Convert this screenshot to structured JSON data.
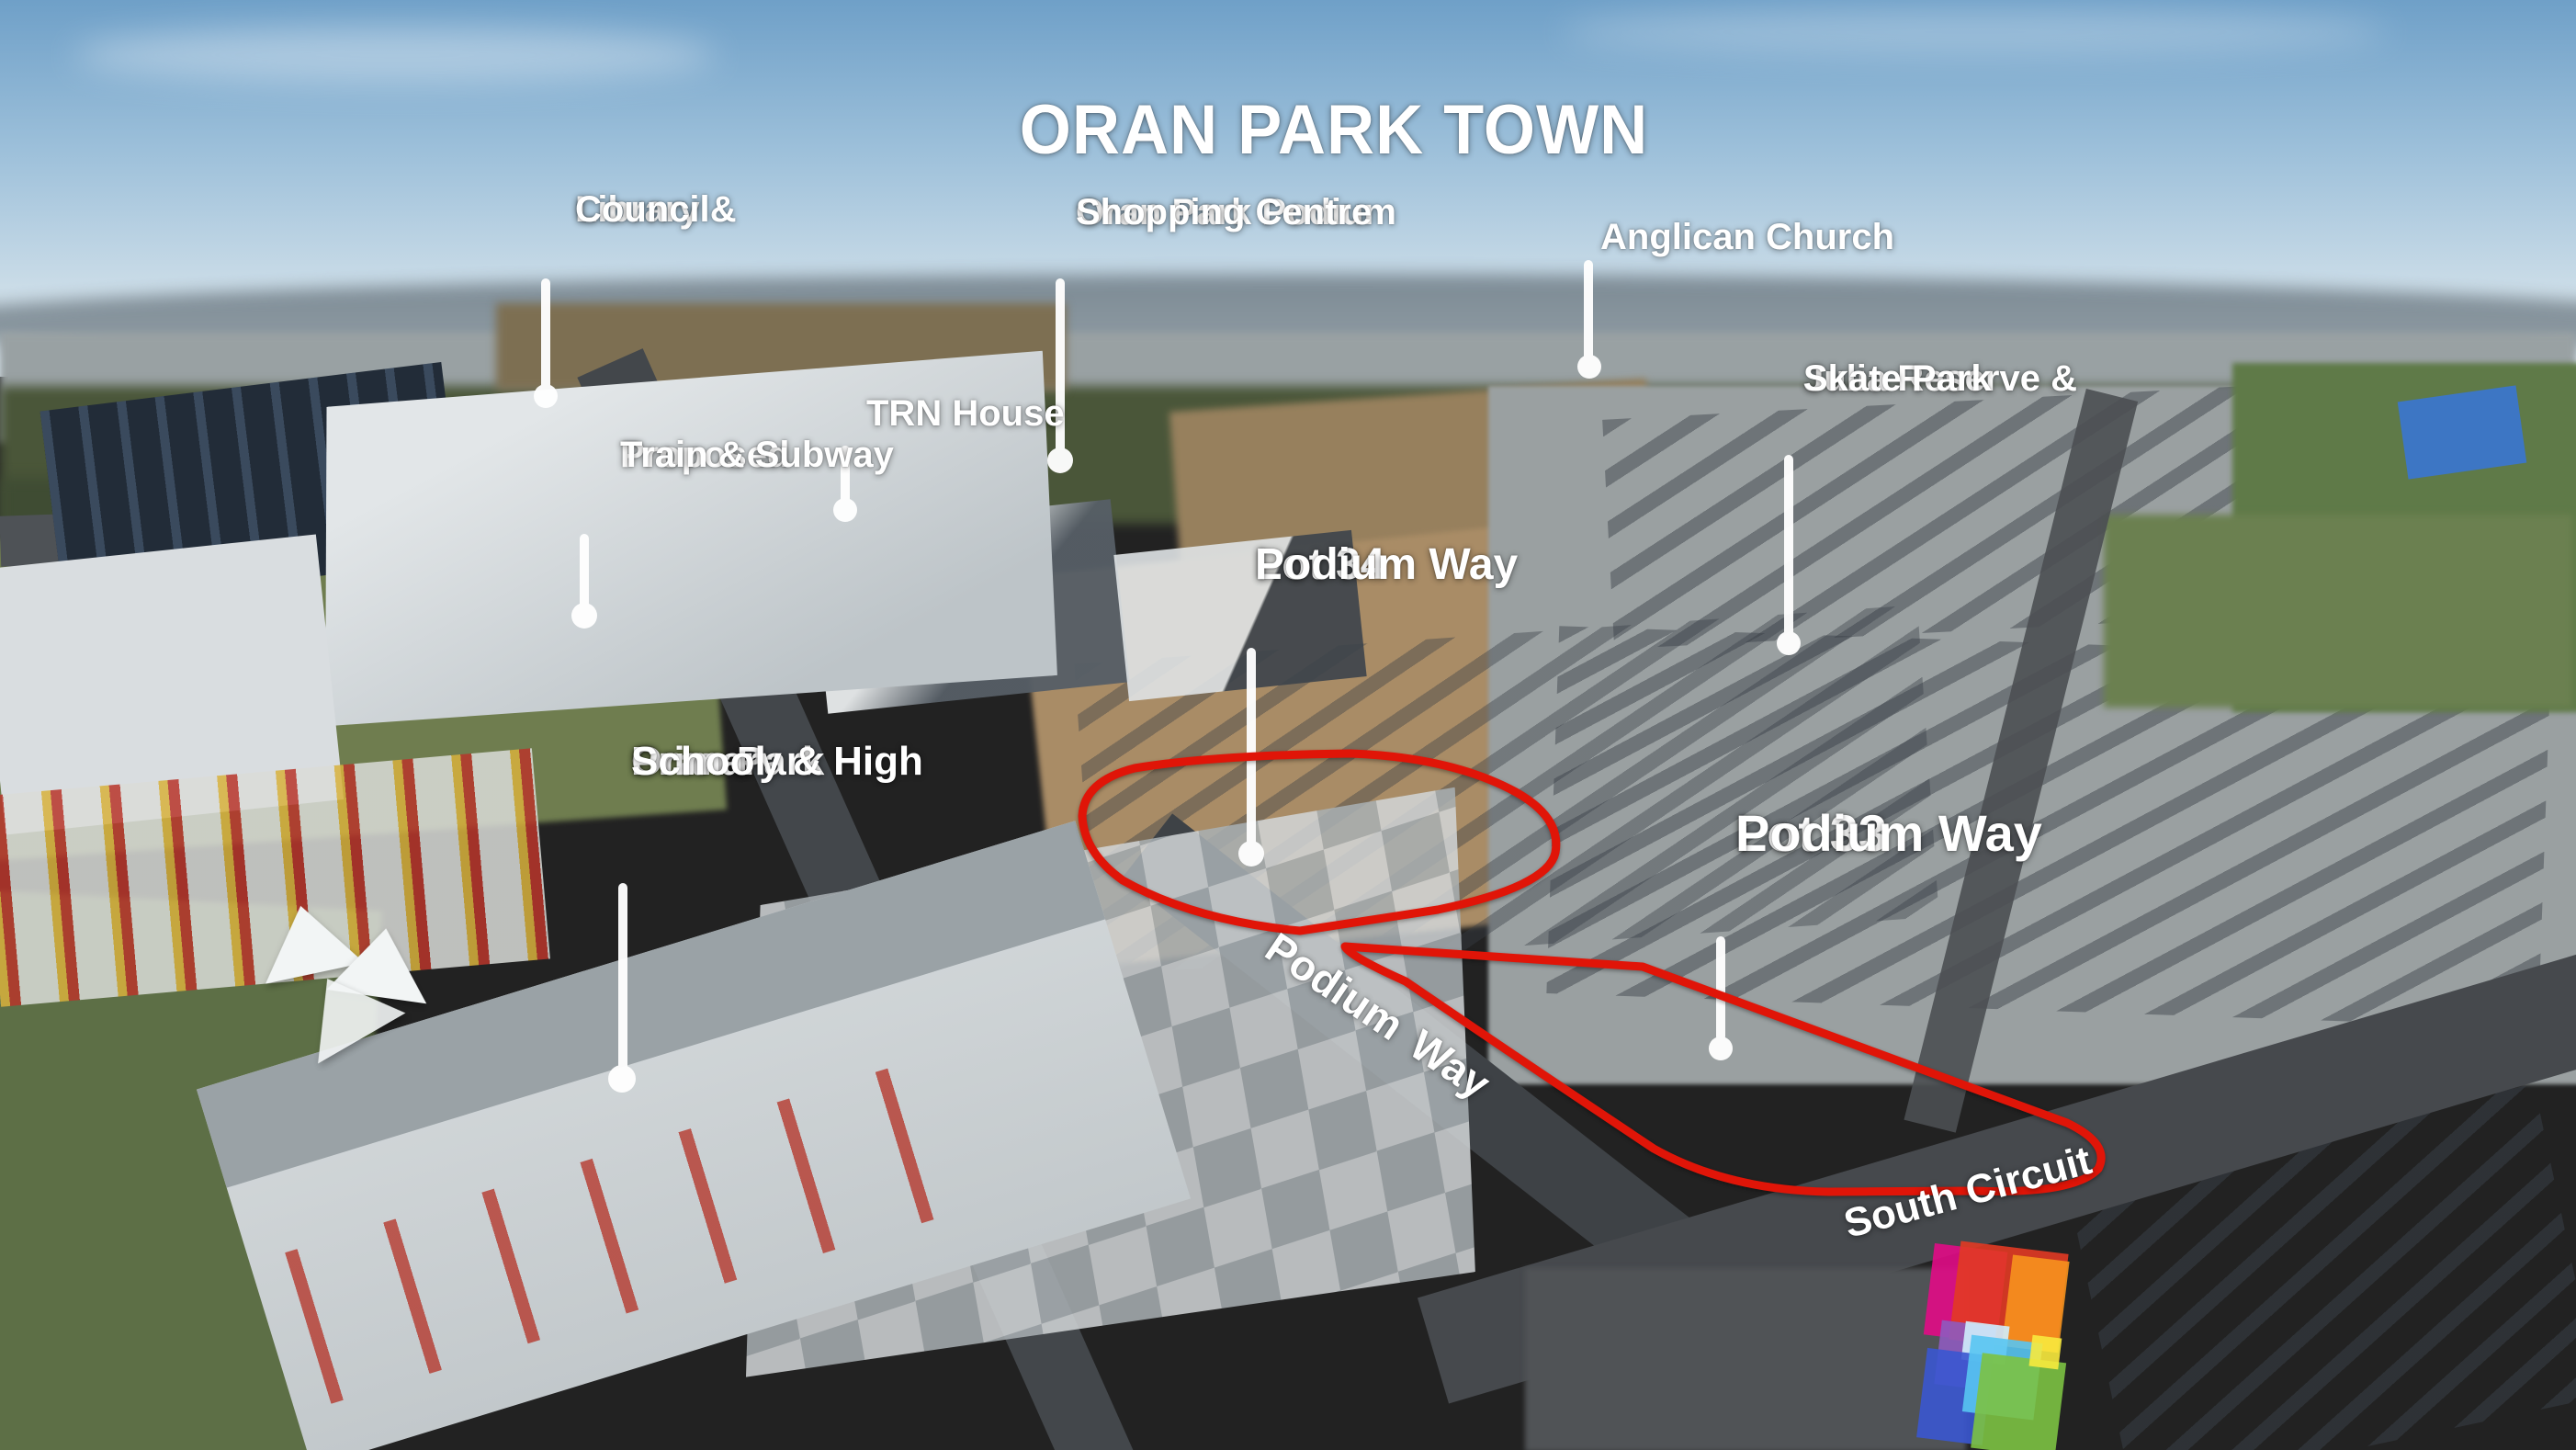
{
  "title": "ORAN PARK TOWN",
  "labels": {
    "library": {
      "line1": "Library &",
      "line2": "Council"
    },
    "shopping": {
      "line1": "Oran Park Podium",
      "line2": "Shopping Centre"
    },
    "anglican": {
      "line1": "Anglican Church"
    },
    "julia": {
      "line1": "Julia Reserve &",
      "line2": "Skate Park"
    },
    "trn": {
      "line1": "TRN House"
    },
    "proposed": {
      "line1": "Proposed",
      "line2": "Train & Subway"
    },
    "lot34": {
      "line1": "Lot 34",
      "line2": "Podium Way"
    },
    "lot33": {
      "line1": "Lot 33",
      "line2": "Podium Way"
    },
    "school": {
      "line1": "Oran Park",
      "line2": "Primary & High",
      "line3": "School"
    }
  },
  "street_labels": {
    "podium_way": "Podium Way",
    "south_circuit": "South Circuit"
  },
  "colors": {
    "annotation": "#ffffff",
    "outline_red": "#e01508",
    "logo_magenta": "#e10b86",
    "logo_red": "#e23a24",
    "logo_orange": "#f6921e",
    "logo_purple": "#8e5bbf",
    "logo_paleblue": "#cfeefc",
    "logo_blue": "#3a57d0",
    "logo_lightblue": "#58c5f2",
    "logo_green": "#7cc242",
    "logo_yellow": "#f8ea3d"
  },
  "logo": {
    "name": "Oran Park Town colour-mosaic logo"
  }
}
